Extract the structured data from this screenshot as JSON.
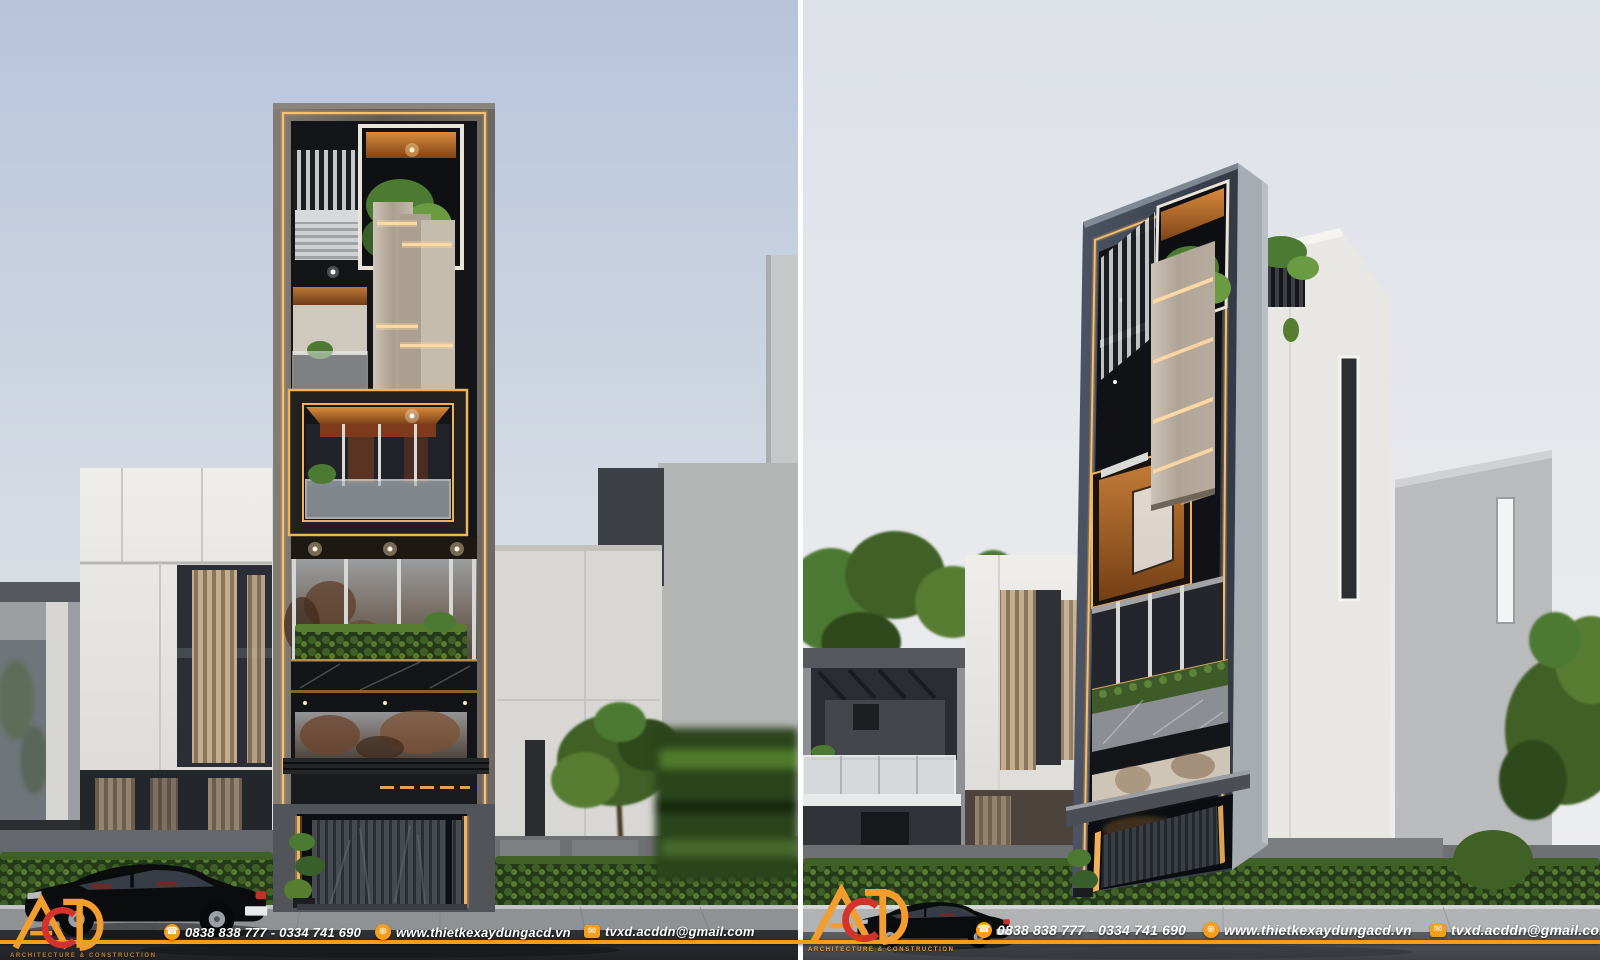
{
  "brand": {
    "logo_text": "ACD",
    "tagline": "ARCHITECTURE & CONSTRUCTION",
    "colors": {
      "accent_orange": "#F59E1C",
      "logo_red": "#D4332B",
      "led_warm": "#F2B25C"
    }
  },
  "contact": {
    "phone": "0838 838 777 - 0334 741 690",
    "website": "www.thietkexaydungacd.vn",
    "email": "tvxd.acddn@gmail.com"
  },
  "scene_colors": {
    "sky_left_top": "#B7C4DC",
    "sky_right_top": "#DDE1E8",
    "tower_dark": "#15161A",
    "stone_frame": "#6F6A66",
    "beige_panels": "#C9BFB2",
    "wood": "#C97B35",
    "hedge_green": "#3F6126"
  }
}
